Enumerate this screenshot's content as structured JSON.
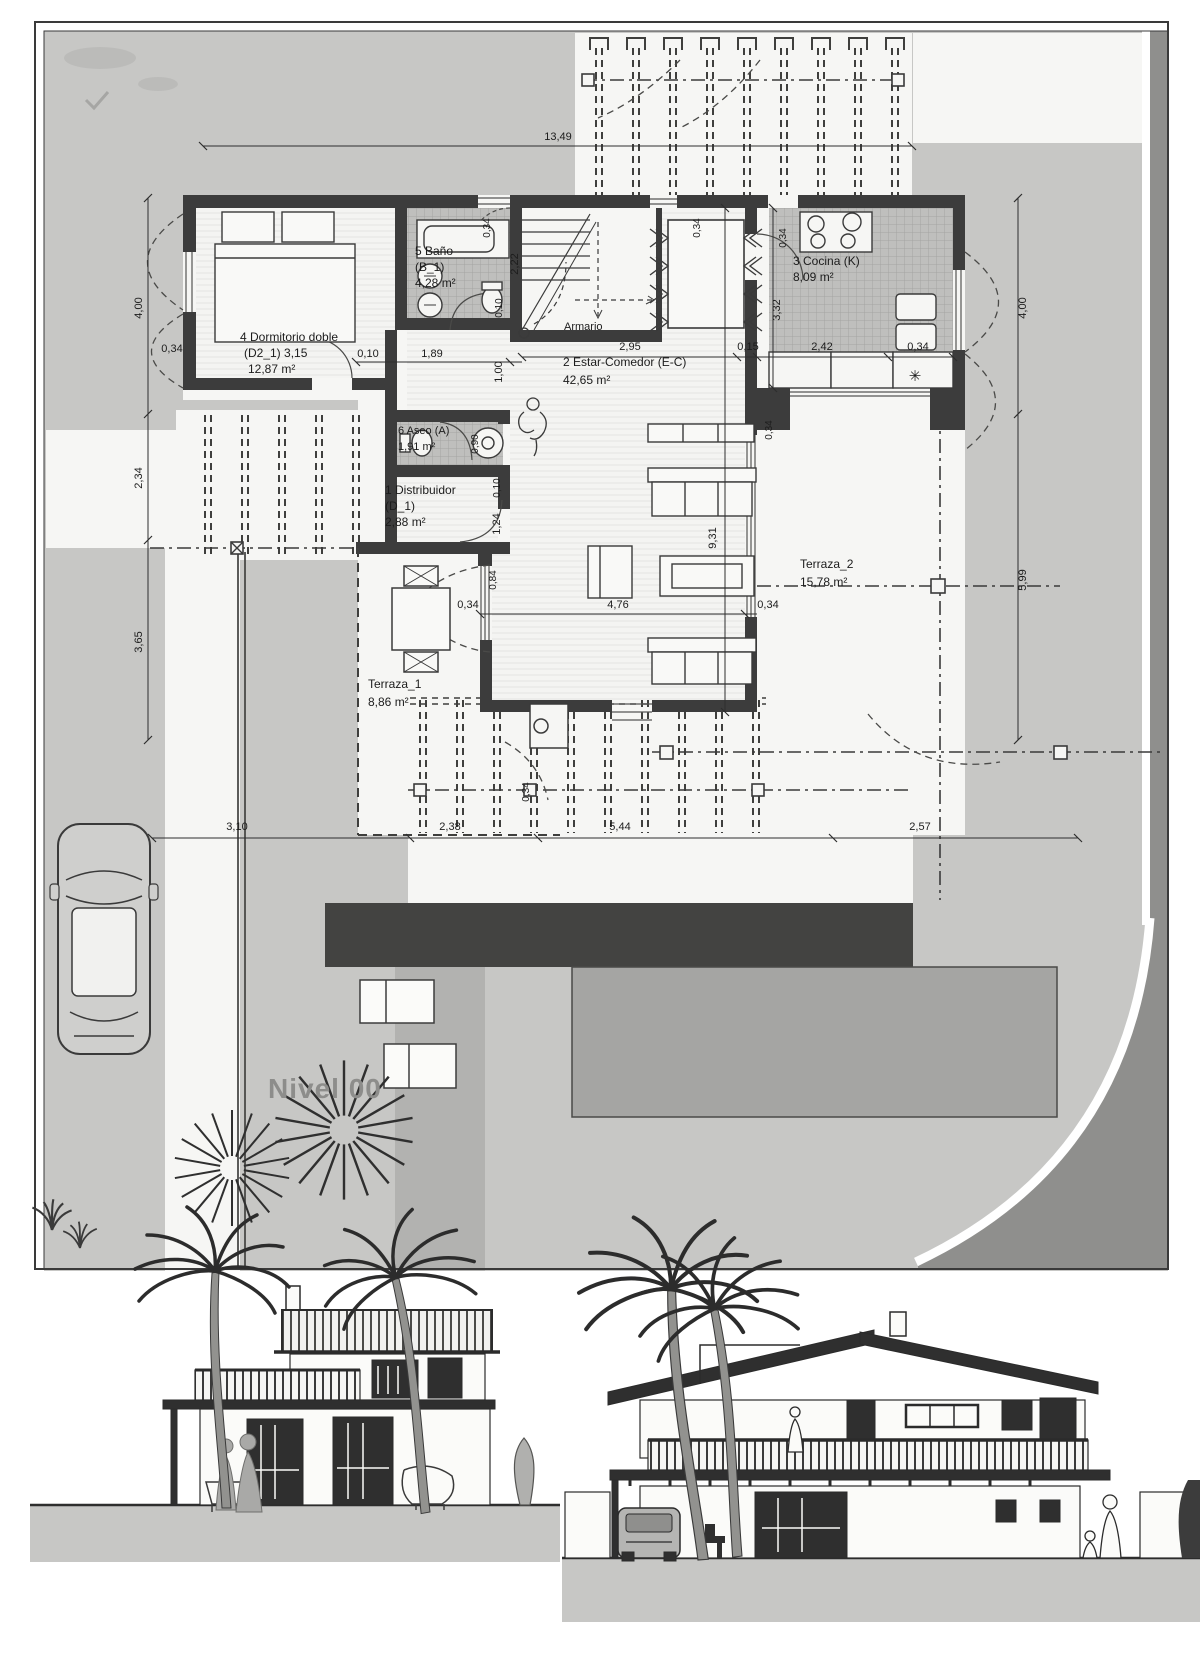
{
  "level_label": "Nivel 00",
  "rooms": {
    "distribuidor": {
      "line1": "1 Distribuidor",
      "line2": "(D_1)",
      "area": "2,88 m²"
    },
    "estar": {
      "line1": "2 Estar-Comedor (E-C)",
      "area": "42,65 m²"
    },
    "cocina": {
      "line1": "3 Cocina (K)",
      "area": "8,09 m²"
    },
    "dormitorio": {
      "line1": "4 Dormitorio doble",
      "line2": "(D2_1) 3,15",
      "area": "12,87 m²"
    },
    "bano": {
      "line1": "5 Baño",
      "line2": "(B_1)",
      "area": "4,28 m²"
    },
    "aseo": {
      "line1": "6 Aseo (A)",
      "area": "1,91 m²"
    },
    "armario": {
      "line1": "Armario"
    },
    "terraza1": {
      "line1": "Terraza_1",
      "area": "8,86 m²"
    },
    "terraza2": {
      "line1": "Terraza_2",
      "area": "15,78 m²"
    }
  },
  "dimensions": {
    "total_width": "13,49",
    "left_top": "4,00",
    "left_middle": "2,34",
    "left_bottom": "3,65",
    "left_wall": "0,34",
    "right_top": "4,00",
    "right_bottom": "5,99",
    "bottom_1": "3,10",
    "bottom_2": "2,38",
    "bottom_3": "5,44",
    "bottom_4": "2,57",
    "bedroom_gap": "0,10",
    "bedroom_bath": "1,89",
    "kitchen_1": "2,95",
    "kitchen_2": "0,15",
    "kitchen_3": "2,42",
    "kitchen_4": "0,34",
    "kitchen_depth": "3,32",
    "kitchen_door": "0,34",
    "bath_depth": "2,22",
    "bath_wall": "0,10",
    "stair_door": "0,34",
    "dining_door": "0,34",
    "stair_width": "1,00",
    "shower": "0,90",
    "aseo_wall": "0,10",
    "distribuidor_depth": "1,24",
    "estar_depth": "9,31",
    "terrace_left": "0,34",
    "terrace_width": "4,76",
    "terrace_right": "0,34",
    "terrace_step": "0,84",
    "terraza2_wall": "0,34",
    "opening": "0,34"
  },
  "symbols": {
    "kitchen_appliance": "✳"
  },
  "colors": {
    "lot_gray": "#c7c7c5",
    "white_zone": "#f6f6f4",
    "wall": "#3c3c3c",
    "deck_dark": "#434341",
    "pool_gray": "#a5a5a3",
    "road_gray": "#8f8f8d",
    "nivel_text": "#8d8d8b"
  }
}
